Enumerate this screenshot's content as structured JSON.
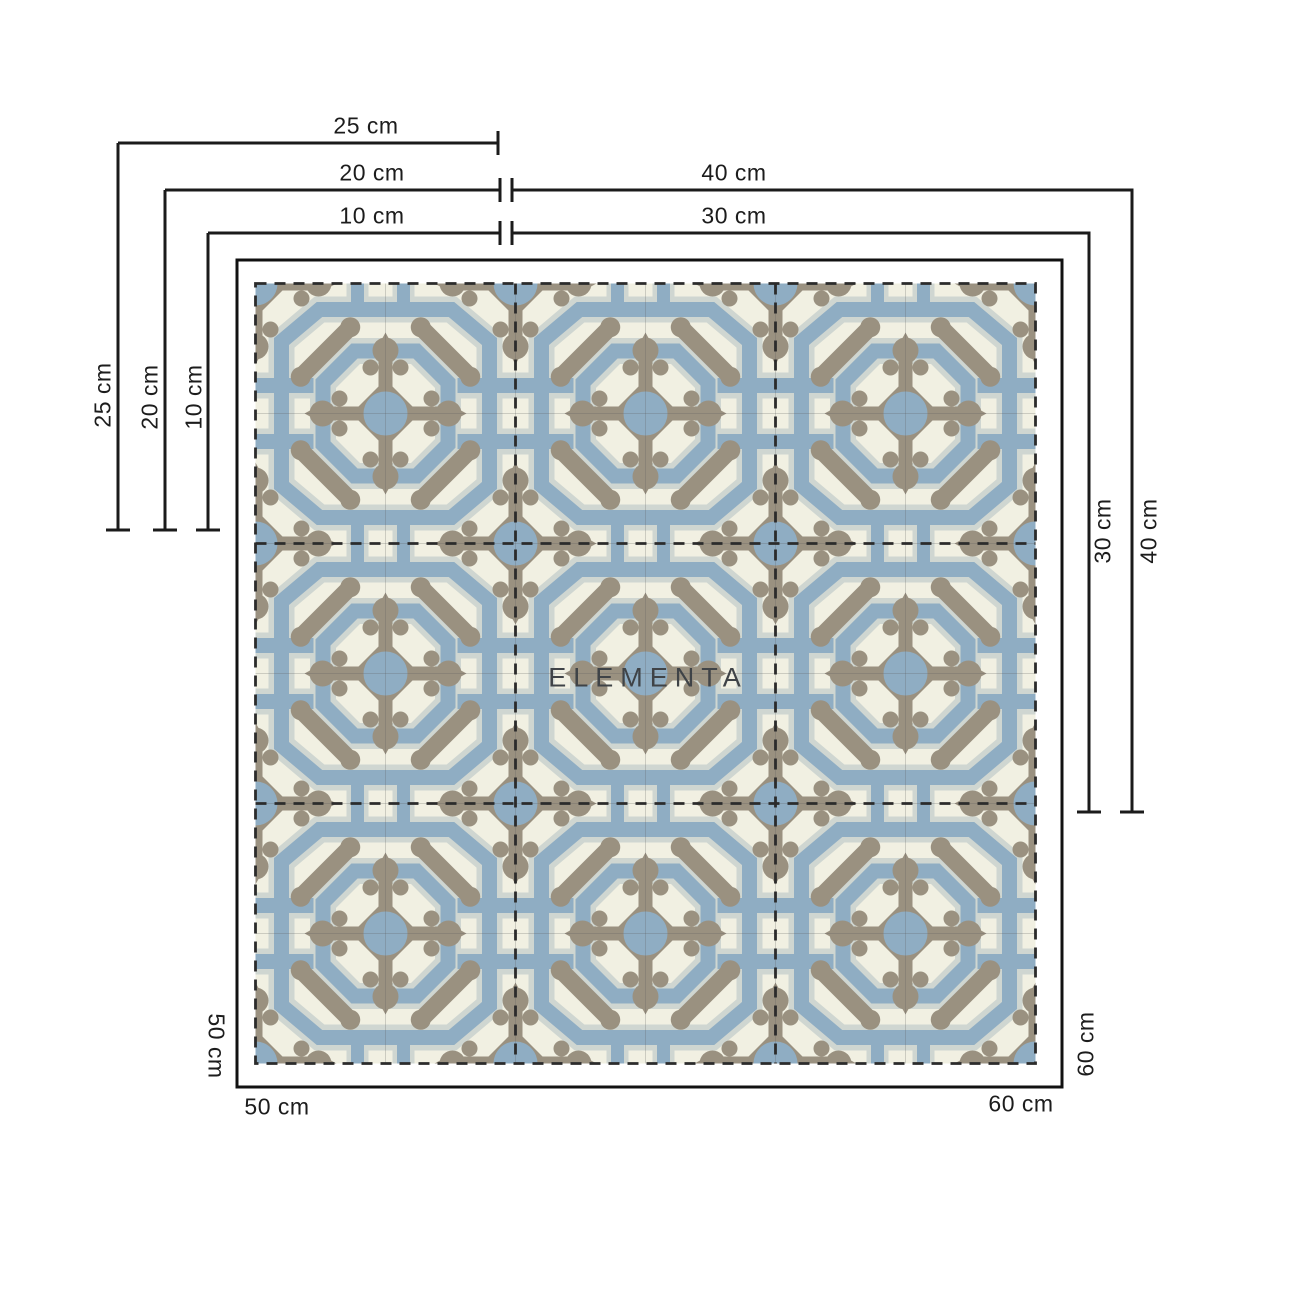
{
  "watermark": "ELEMENTA",
  "diagram": {
    "type": "tile-size-diagram",
    "tile_grid": "3x3",
    "colors": {
      "cream": "#f1f0e2",
      "slate_blue": "#8fadc3",
      "taupe": "#9a9180",
      "light_gray": "#cfd6d1",
      "dimension_line": "#1b1b1b",
      "dashed_outline": "#2b2b2b"
    }
  },
  "dimension_lines": {
    "top_horizontal_left": [
      "25 cm",
      "20 cm",
      "10 cm"
    ],
    "top_horizontal_right": [
      "40 cm",
      "30 cm"
    ],
    "left_vertical": [
      "25 cm",
      "20 cm",
      "10 cm"
    ],
    "right_vertical": [
      "30 cm",
      "40 cm"
    ],
    "bottom_left": {
      "vertical": "50 cm",
      "horizontal": "50 cm"
    },
    "bottom_right": {
      "vertical": "60 cm",
      "horizontal": "60 cm"
    }
  }
}
